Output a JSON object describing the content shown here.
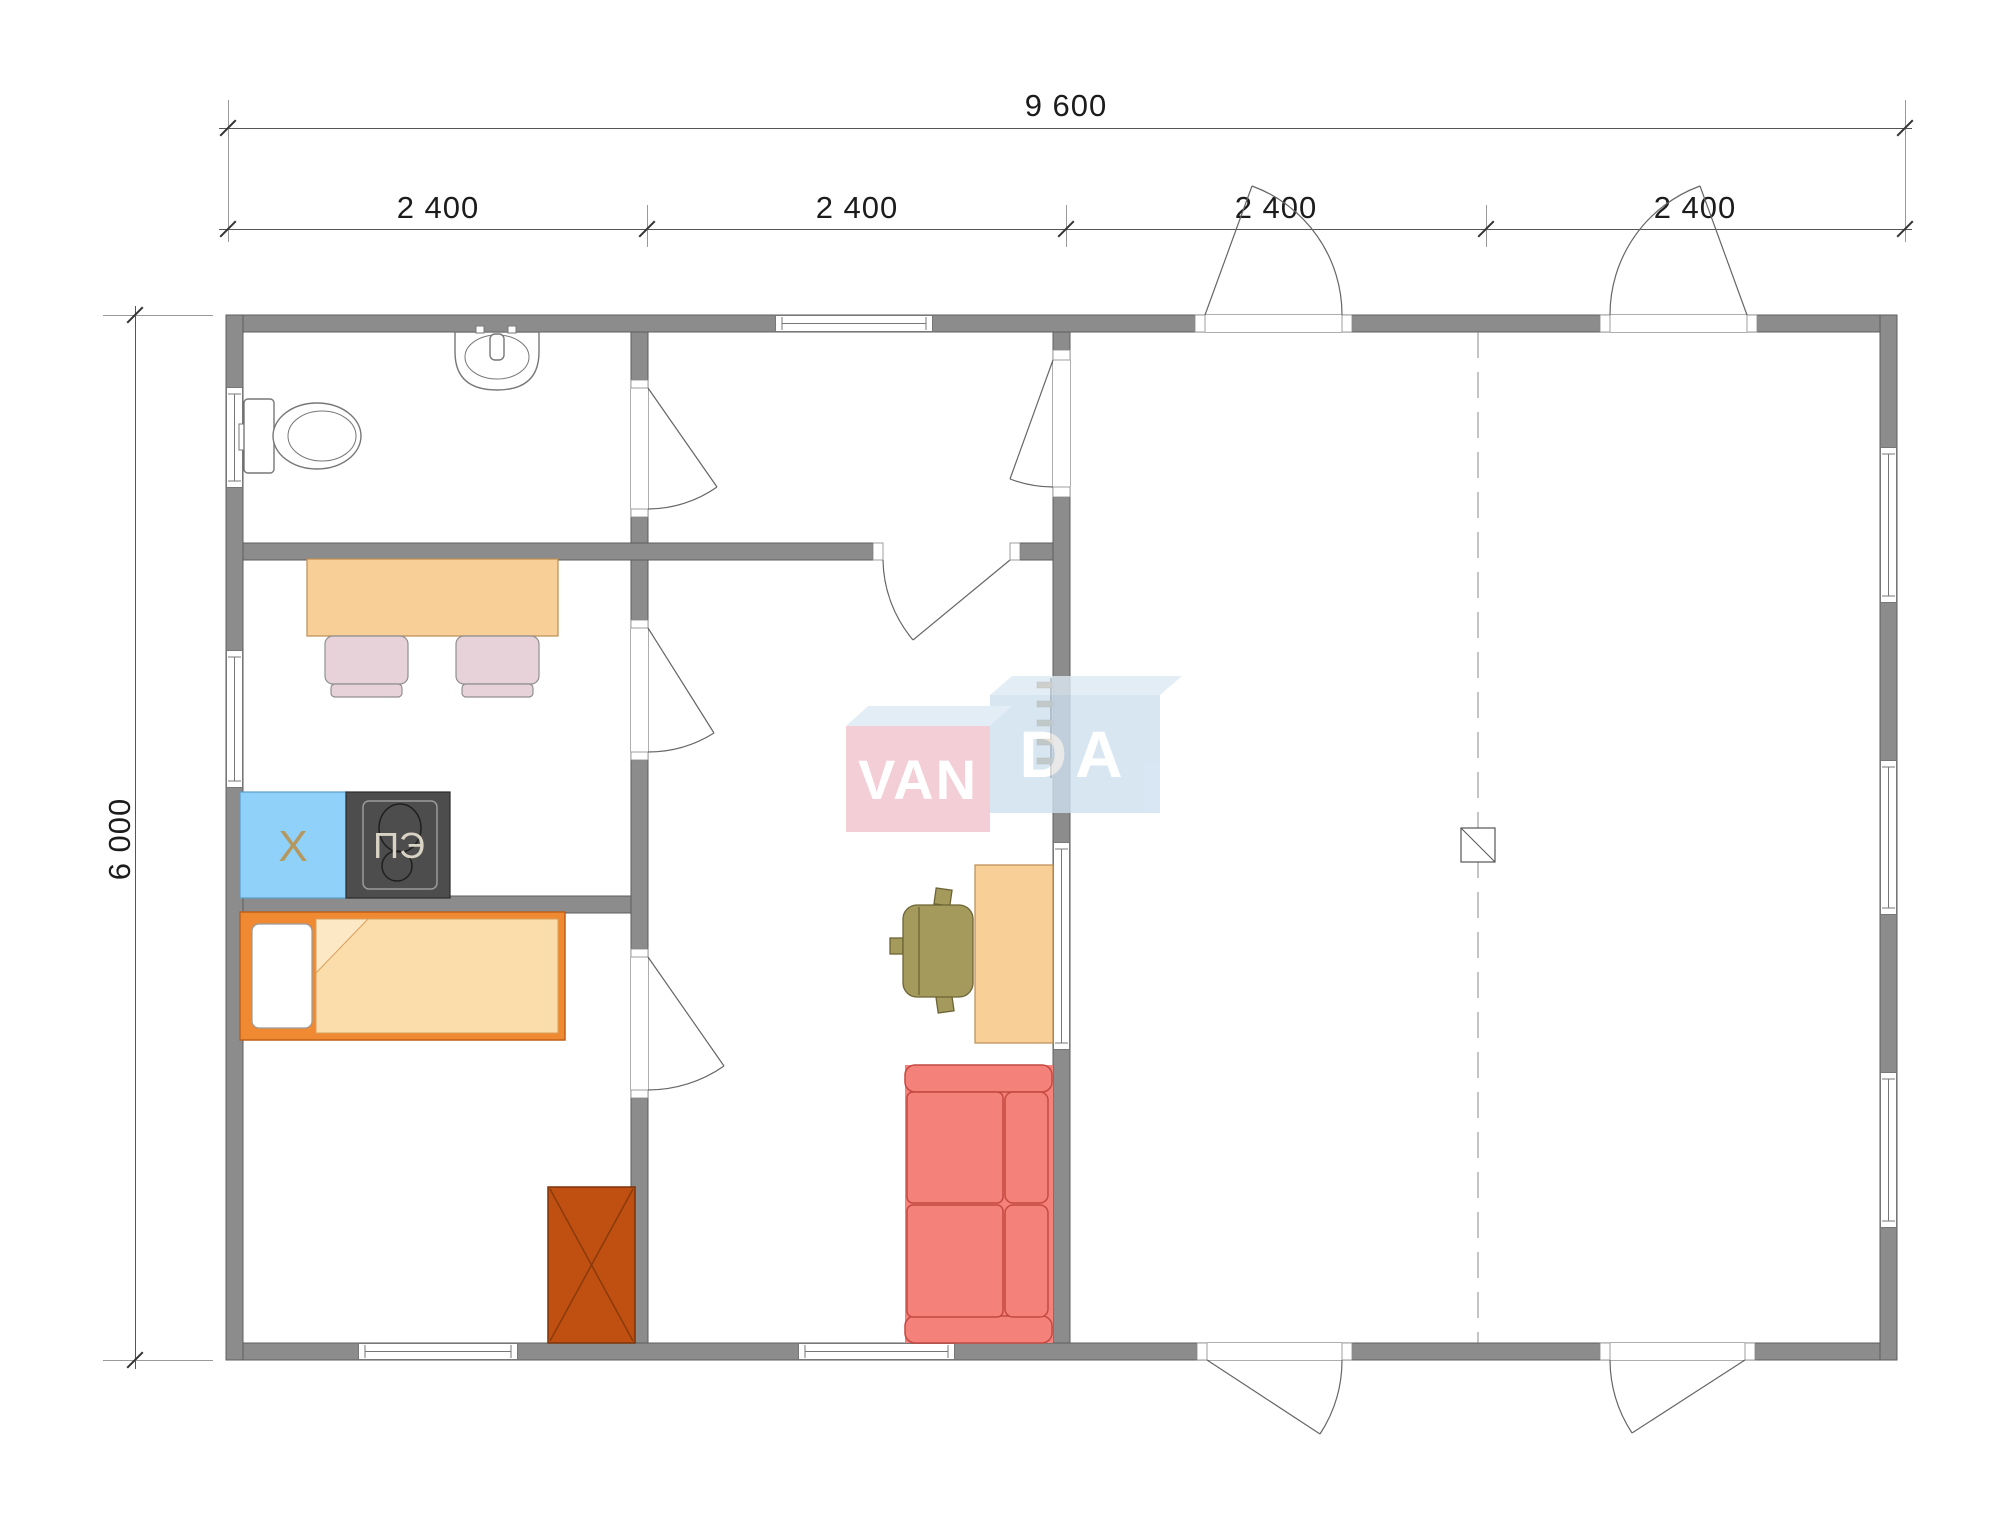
{
  "watermark": {
    "van": "VAN",
    "da": "DA",
    "full": "VANDA"
  },
  "dimensions": {
    "total_width": "9 600",
    "segments": [
      "2 400",
      "2 400",
      "2 400",
      "2 400"
    ],
    "total_height": "6 000"
  },
  "appliance_labels": {
    "fridge": "Х",
    "stove": "ПЭ"
  },
  "icons": [
    "toilet-icon",
    "sink-icon",
    "dining-table",
    "chair-icon",
    "fridge-icon",
    "stove-icon",
    "bed-icon",
    "wardrobe-icon",
    "desk-icon",
    "office-chair-icon",
    "sofa-icon",
    "wall-ladder-icon",
    "column-post-icon",
    "door-swing-icon",
    "window-icon"
  ],
  "colors": {
    "wall": "#8c8c8c",
    "wallEdge": "#5e5e5e",
    "dimLine": "#555555",
    "dimText": "#1c1c1c",
    "doorArc": "#666666",
    "table": "#f8cf97",
    "tableEdge": "#bb8d54",
    "chair": "#e7d2da",
    "chairEdge": "#8f8f8f",
    "fridge": "#8fd1f8",
    "fridgeEdge": "#5b9ec9",
    "fridgeMark": "#b9924f",
    "stove": "#4d4d4d",
    "stoveEdge": "#2c2c2c",
    "stovePanel": "#9c9c9c",
    "stoveText": "#d8d3c4",
    "bedFrame": "#ef8a33",
    "bedFrameEdge": "#c05f17",
    "blanket": "#fbdcab",
    "blanketEdge": "#d9a05b",
    "blanketFold": "#fde8c6",
    "wardrobe": "#bf5011",
    "wardrobeEdge": "#7c3309",
    "wardrobeMark": "#8a3a0c",
    "deskChair": "#a39a5c",
    "deskChairEdge": "#6d6436",
    "sofa": "#f5827a",
    "sofaEdge": "#c24a42",
    "ladder": "#8a6a28",
    "logoPink": "#f2c2cd",
    "logoBlue": "#cfe0f0",
    "logoBevel": "#dde9f4",
    "logoText": "#ffffff"
  }
}
